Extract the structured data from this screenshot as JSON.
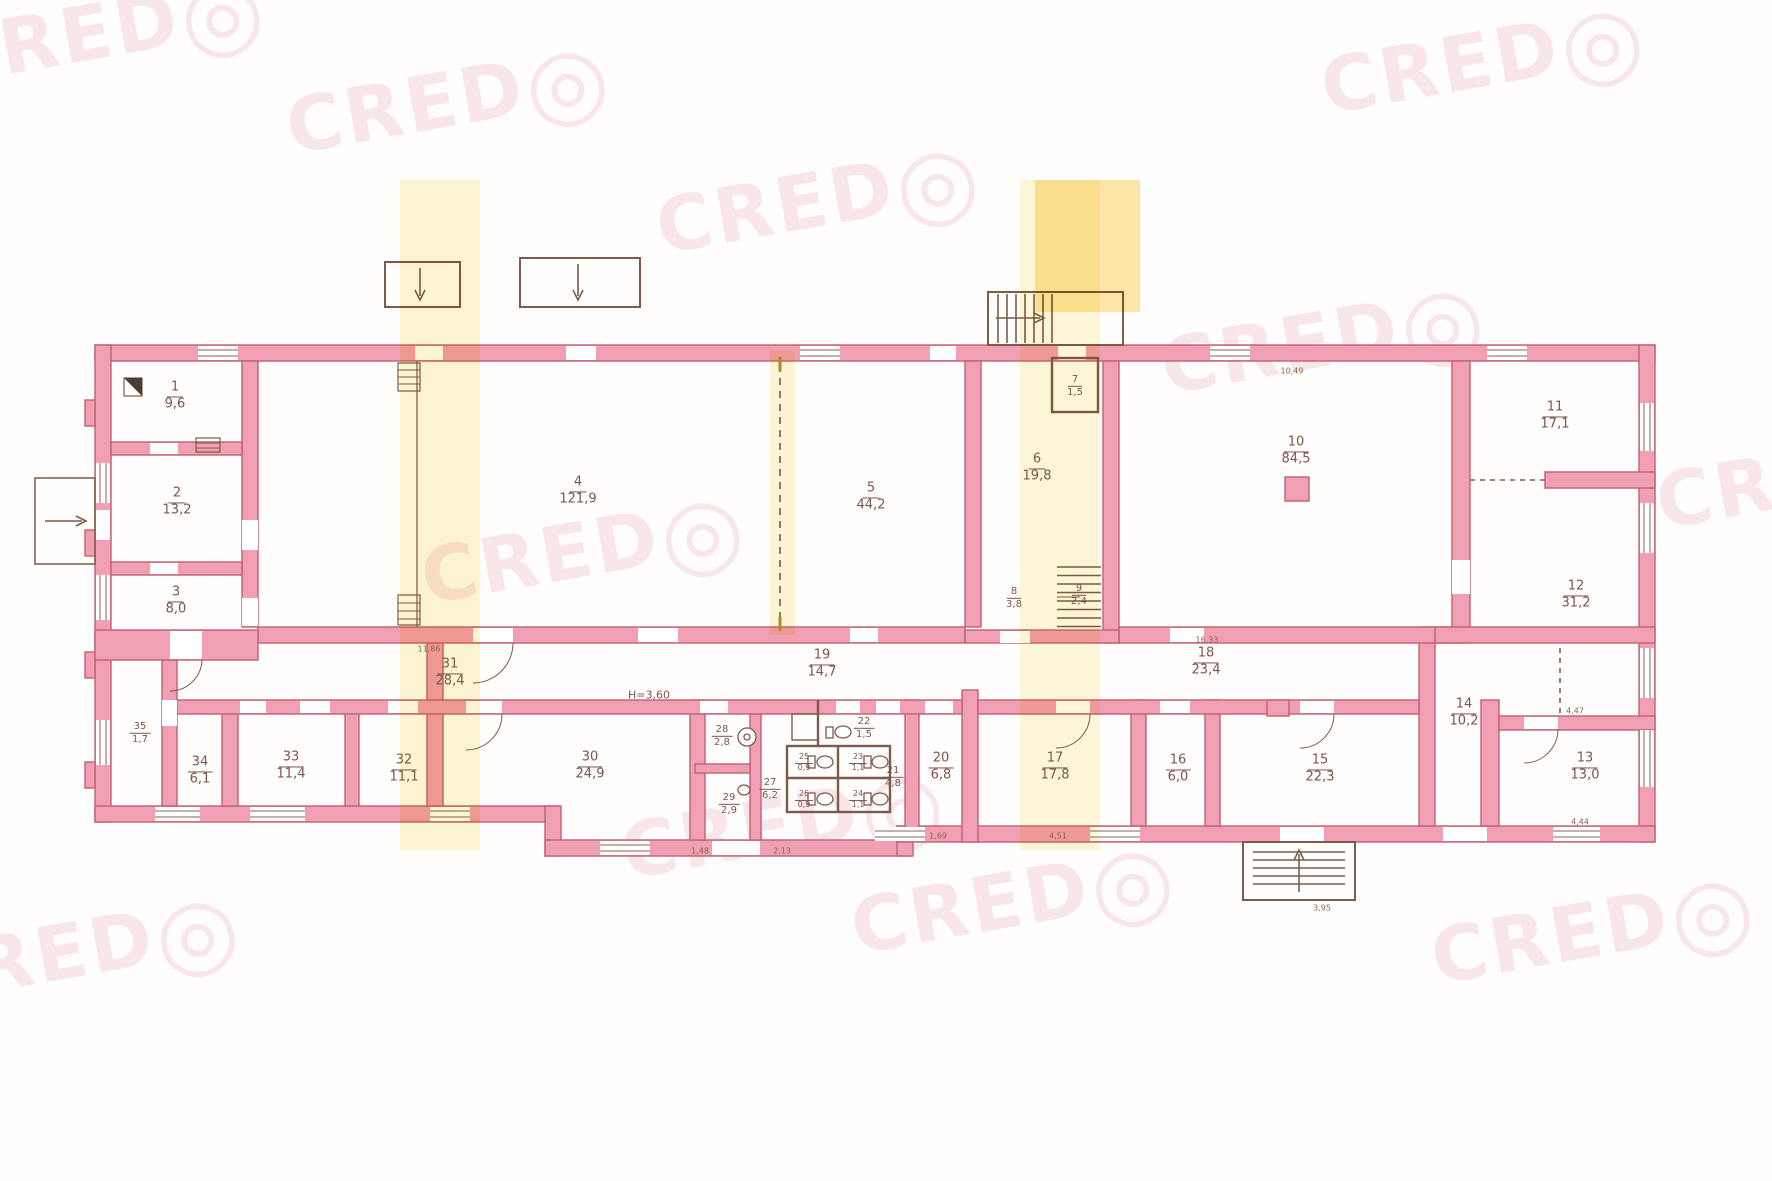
{
  "document": {
    "type": "scanned-floor-plan",
    "height_note": "H=3,60",
    "colors": {
      "wall_fill": "#f19fb2",
      "wall_stroke": "#bf6272",
      "ink": "#7d564a",
      "watermark": "#db6a7a",
      "scan_band": "#f8e28c"
    }
  },
  "watermark": {
    "text": "CRED",
    "o": "◎"
  },
  "plan": {
    "rooms": [
      {
        "number": "1",
        "area": "9,6"
      },
      {
        "number": "2",
        "area": "13,2"
      },
      {
        "number": "3",
        "area": "8,0"
      },
      {
        "number": "4",
        "area": "121,9"
      },
      {
        "number": "5",
        "area": "44,2"
      },
      {
        "number": "6",
        "area": "19,8"
      },
      {
        "number": "7",
        "area": "1,5"
      },
      {
        "number": "8",
        "area": "3,8"
      },
      {
        "number": "9",
        "area": "2,4"
      },
      {
        "number": "10",
        "area": "84,5"
      },
      {
        "number": "11",
        "area": "17,1"
      },
      {
        "number": "12",
        "area": "31,2"
      },
      {
        "number": "13",
        "area": "13,0"
      },
      {
        "number": "14",
        "area": "10,2"
      },
      {
        "number": "15",
        "area": "22,3"
      },
      {
        "number": "16",
        "area": "6,0"
      },
      {
        "number": "17",
        "area": "17,8"
      },
      {
        "number": "18",
        "area": "23,4"
      },
      {
        "number": "19",
        "area": "14,7"
      },
      {
        "number": "20",
        "area": "6,8"
      },
      {
        "number": "21",
        "area": "4,8"
      },
      {
        "number": "22",
        "area": "1,5"
      },
      {
        "number": "23",
        "area": "1,1"
      },
      {
        "number": "24",
        "area": "1,1"
      },
      {
        "number": "25",
        "area": "0,9"
      },
      {
        "number": "26",
        "area": "0,9"
      },
      {
        "number": "27",
        "area": "6,2"
      },
      {
        "number": "28",
        "area": "2,8"
      },
      {
        "number": "29",
        "area": "2,9"
      },
      {
        "number": "30",
        "area": "24,9"
      },
      {
        "number": "31",
        "area": "28,4"
      },
      {
        "number": "32",
        "area": "11,1"
      },
      {
        "number": "33",
        "area": "11,4"
      },
      {
        "number": "34",
        "area": "6,1"
      },
      {
        "number": "35",
        "area": "1,7"
      }
    ],
    "dims": [
      "11,86",
      "16,33",
      "10,49",
      "4,47",
      "4,44",
      "4,51",
      "1,69",
      "3,95",
      "1,48",
      "2,13"
    ]
  }
}
